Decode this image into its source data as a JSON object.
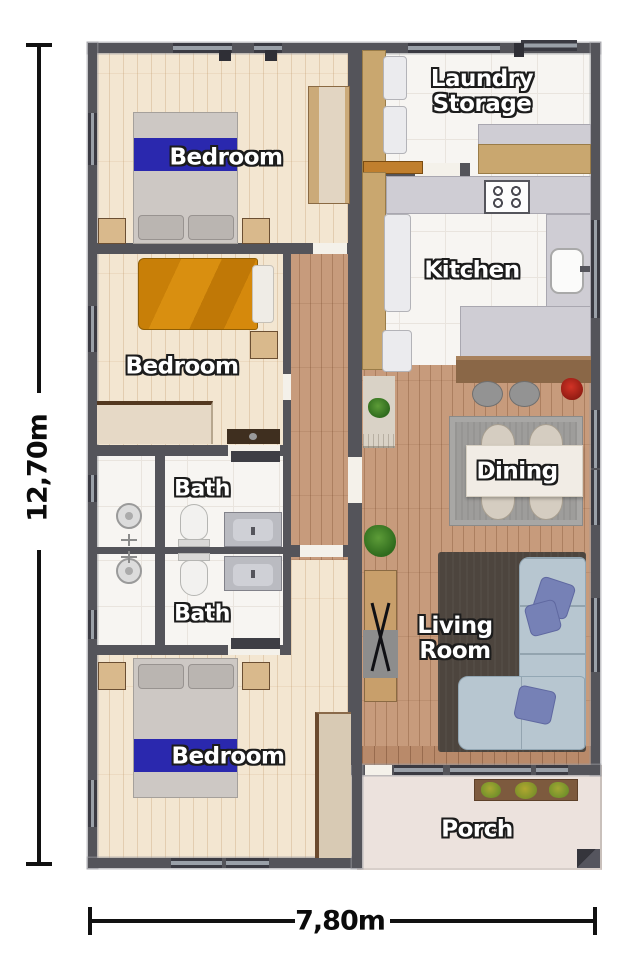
{
  "dimensions": {
    "height": "12,70m",
    "width": "7,80m"
  },
  "rooms": [
    {
      "id": "bedroom-top",
      "label": "Bedroom"
    },
    {
      "id": "bedroom-middle",
      "label": "Bedroom"
    },
    {
      "id": "bath-upper",
      "label": "Bath"
    },
    {
      "id": "bath-lower",
      "label": "Bath"
    },
    {
      "id": "bedroom-bottom",
      "label": "Bedroom"
    },
    {
      "id": "laundry-storage",
      "label_line1": "Laundry",
      "label_line2": "Storage"
    },
    {
      "id": "kitchen",
      "label": "Kitchen"
    },
    {
      "id": "dining",
      "label": "Dining"
    },
    {
      "id": "living-room",
      "label_line1": "Living",
      "label_line2": "Room"
    },
    {
      "id": "porch",
      "label": "Porch"
    }
  ],
  "colors": {
    "wall": "#54545a",
    "pale_floor": "#f3e6d1",
    "wood_floor": "#c79b7c",
    "tile_floor": "#f7f5f2",
    "porch_floor": "#ece2dd",
    "bed_runner_blue": "#2a28ae",
    "bed_orange": "#d5890c",
    "sofa_blue": "#b7c6d0",
    "pillow_blue": "#7681b6",
    "living_rug": "#4d453e",
    "dining_rug": "#9e9d9b",
    "counter_gray": "#cfcdd4",
    "counter_wood": "#c9a76f",
    "bar_wood": "#8a6747",
    "dimension_text": "#111111"
  },
  "icons": {
    "plant-icon": "green radial blob",
    "red-plant-icon": "red radial blob",
    "stove-icon": "four burner circles",
    "sink-icon": "rounded basin with faucet",
    "shower-icon": "circle shower head with valve cross",
    "toilet-icon": "oval bowl with tank",
    "window-icon": "dark bar with light glazing line"
  }
}
